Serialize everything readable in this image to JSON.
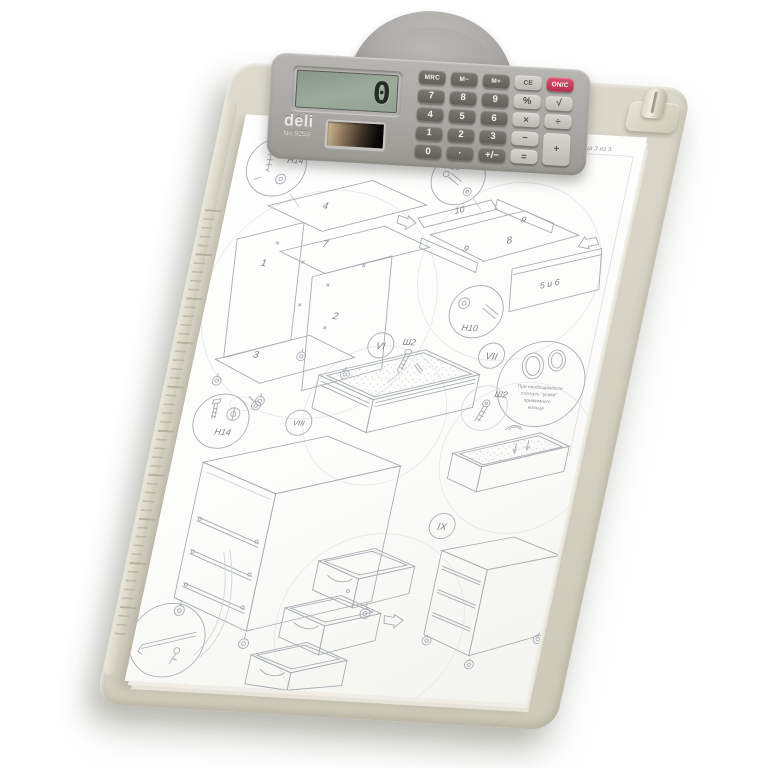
{
  "scene": {
    "background": "#ffffff"
  },
  "clipboard": {
    "colors": {
      "board": "#d7d4c5",
      "edge": "#cfccbc"
    }
  },
  "calculator": {
    "brand": "deli",
    "model": "No.9259",
    "display_value": "0",
    "colors": {
      "body": "#a9a8a4",
      "lcd": "#96a496",
      "key_dark": "#666560",
      "key_light": "#c6c5bf",
      "key_accent": "#c2395a"
    },
    "keys": [
      {
        "label": "MRC"
      },
      {
        "label": "M−"
      },
      {
        "label": "M+"
      },
      {
        "label": "CE"
      },
      {
        "label": "ON/C"
      },
      {
        "label": "7"
      },
      {
        "label": "8"
      },
      {
        "label": "9"
      },
      {
        "label": "%"
      },
      {
        "label": "√"
      },
      {
        "label": "4"
      },
      {
        "label": "5"
      },
      {
        "label": "6"
      },
      {
        "label": "×"
      },
      {
        "label": "÷"
      },
      {
        "label": "1"
      },
      {
        "label": "2"
      },
      {
        "label": "3"
      },
      {
        "label": "−"
      },
      {
        "label": "+"
      },
      {
        "label": "0"
      },
      {
        "label": "·"
      },
      {
        "label": "+/−"
      },
      {
        "label": "="
      }
    ]
  },
  "paper": {
    "page_header": "Страница 3 из 3",
    "labels": {
      "h14": "H14",
      "h10": "H10",
      "sh2": "Ш2",
      "s6": "VI",
      "s7": "VII",
      "s8": "VIII",
      "s9": "IX",
      "p1": "1",
      "p2": "2",
      "p3": "3",
      "p4": "4",
      "p7": "7",
      "p8": "8",
      "p9": "9",
      "p10": "10",
      "p5_6": "5 и 6"
    },
    "note": {
      "l1": "При необходимости",
      "l2": "отогнуть \"усики\"",
      "l3": "прижимного",
      "l4": "кольца"
    }
  }
}
